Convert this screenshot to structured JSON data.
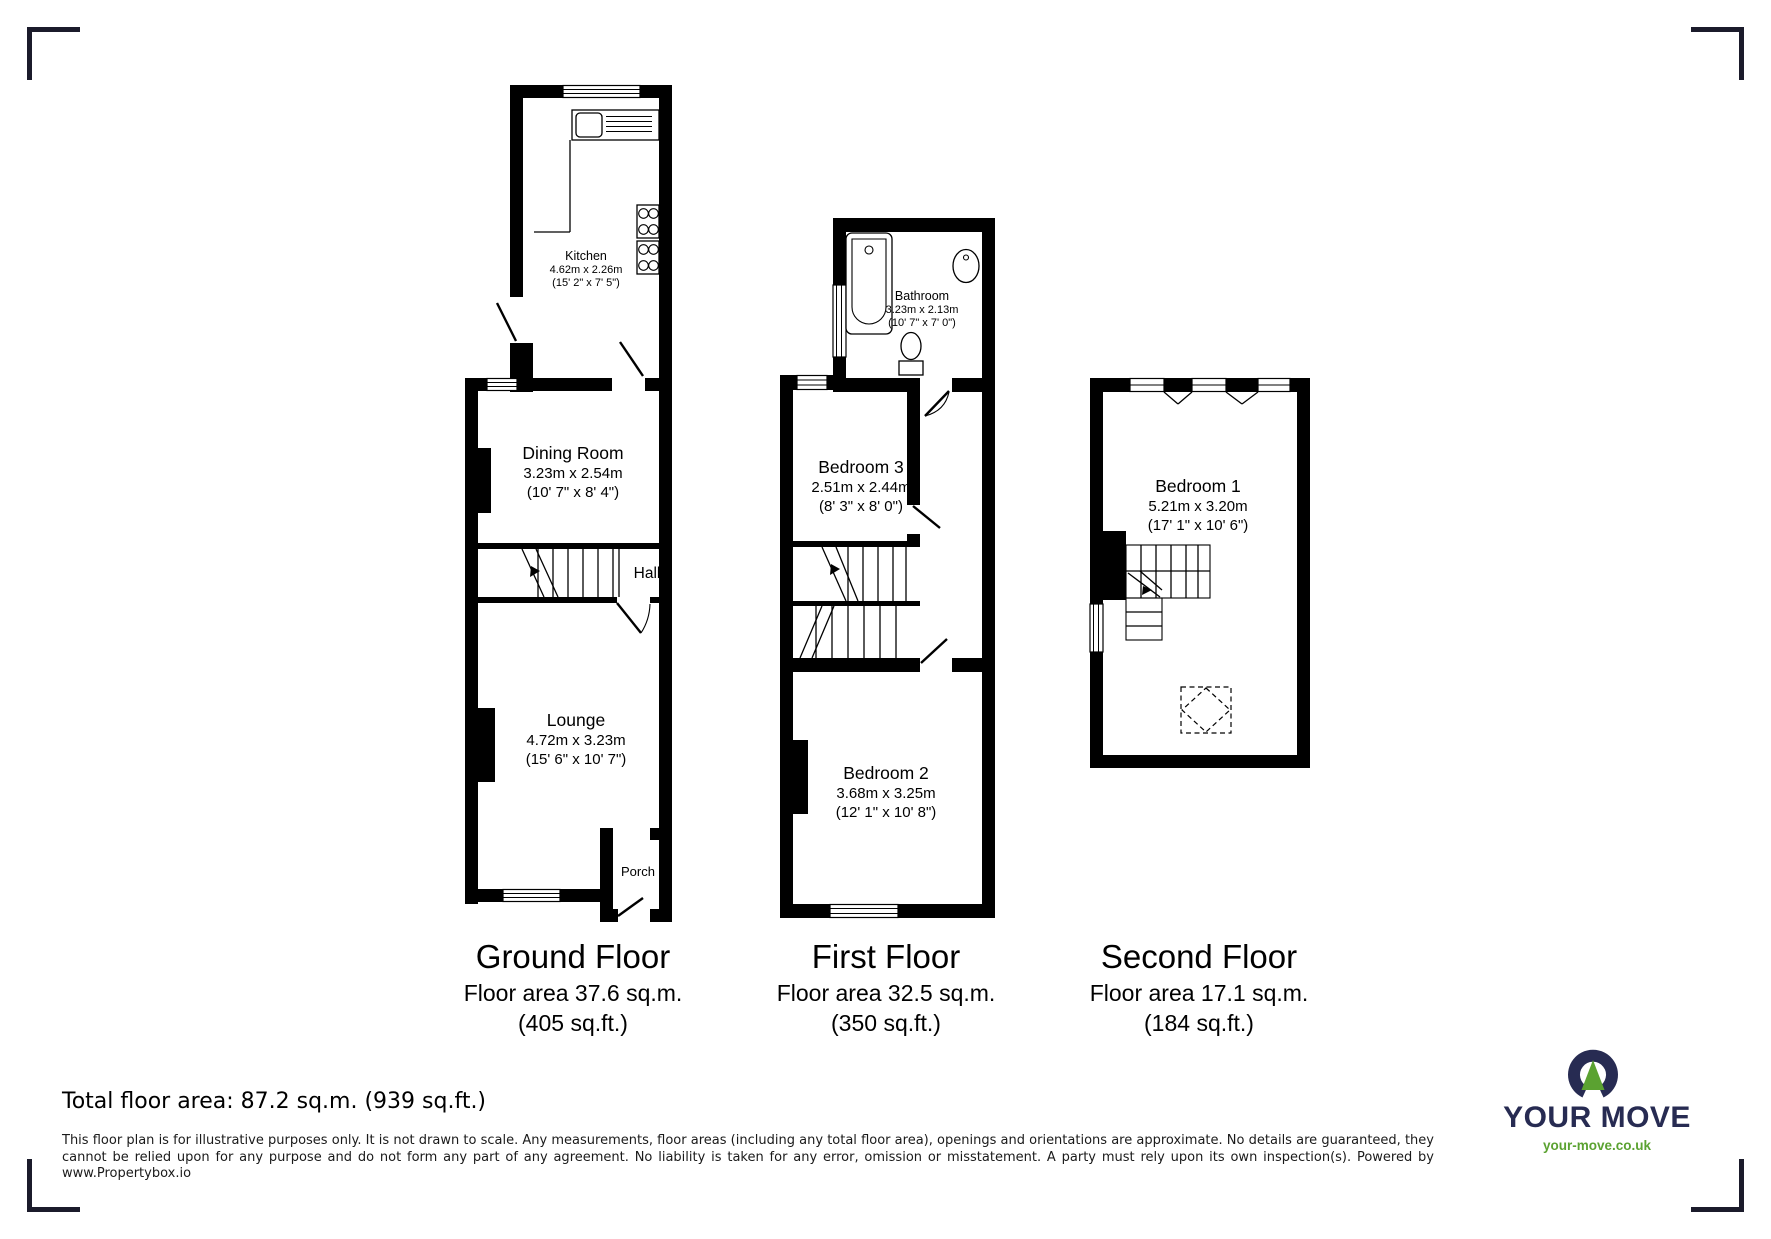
{
  "floors": {
    "ground": {
      "caption": "Ground Floor",
      "area_metric": "Floor area 37.6 sq.m.",
      "area_imperial": "(405 sq.ft.)",
      "rooms": {
        "kitchen": {
          "name": "Kitchen",
          "metric": "4.62m x 2.26m",
          "imperial": "(15' 2\" x 7' 5\")"
        },
        "dining_room": {
          "name": "Dining Room",
          "metric": "3.23m x 2.54m",
          "imperial": "(10' 7\" x 8' 4\")"
        },
        "hall": {
          "name": "Hall"
        },
        "lounge": {
          "name": "Lounge",
          "metric": "4.72m x 3.23m",
          "imperial": "(15' 6\" x 10' 7\")"
        },
        "porch": {
          "name": "Porch"
        }
      }
    },
    "first": {
      "caption": "First Floor",
      "area_metric": "Floor area 32.5 sq.m.",
      "area_imperial": "(350 sq.ft.)",
      "rooms": {
        "bathroom": {
          "name": "Bathroom",
          "metric": "3.23m x 2.13m",
          "imperial": "(10' 7\" x 7' 0\")"
        },
        "bedroom3": {
          "name": "Bedroom 3",
          "metric": "2.51m x 2.44m",
          "imperial": "(8' 3\" x 8' 0\")"
        },
        "bedroom2": {
          "name": "Bedroom 2",
          "metric": "3.68m x 3.25m",
          "imperial": "(12' 1\" x 10' 8\")"
        }
      }
    },
    "second": {
      "caption": "Second Floor",
      "area_metric": "Floor area 17.1 sq.m.",
      "area_imperial": "(184 sq.ft.)",
      "rooms": {
        "bedroom1": {
          "name": "Bedroom 1",
          "metric": "5.21m x 3.20m",
          "imperial": "(17' 1\" x 10' 6\")"
        }
      }
    }
  },
  "summary": {
    "total_area": "Total floor area: 87.2 sq.m. (939 sq.ft.)"
  },
  "disclaimer": "This floor plan is for illustrative purposes only. It is not drawn to scale. Any measurements, floor areas (including any total floor area), openings and orientations are approximate. No details are guaranteed, they cannot be relied upon for any purpose and do not form any part of any agreement. No liability is taken for any error, omission or misstatement. A party must rely upon its own inspection(s). Powered by www.Propertybox.io",
  "logo": {
    "brand": "YOUR MOVE",
    "website": "your-move.co.uk",
    "colors": {
      "navy": "#272b52",
      "green": "#5ba231"
    }
  },
  "symbols": [
    "bathtub-icon",
    "toilet-icon",
    "basin-icon",
    "kitchen-sink-icon",
    "hob-icon",
    "stairs-icon",
    "window-symbol",
    "door-symbol",
    "rooflight-icon",
    "logo-mark-icon",
    "crop-mark"
  ]
}
